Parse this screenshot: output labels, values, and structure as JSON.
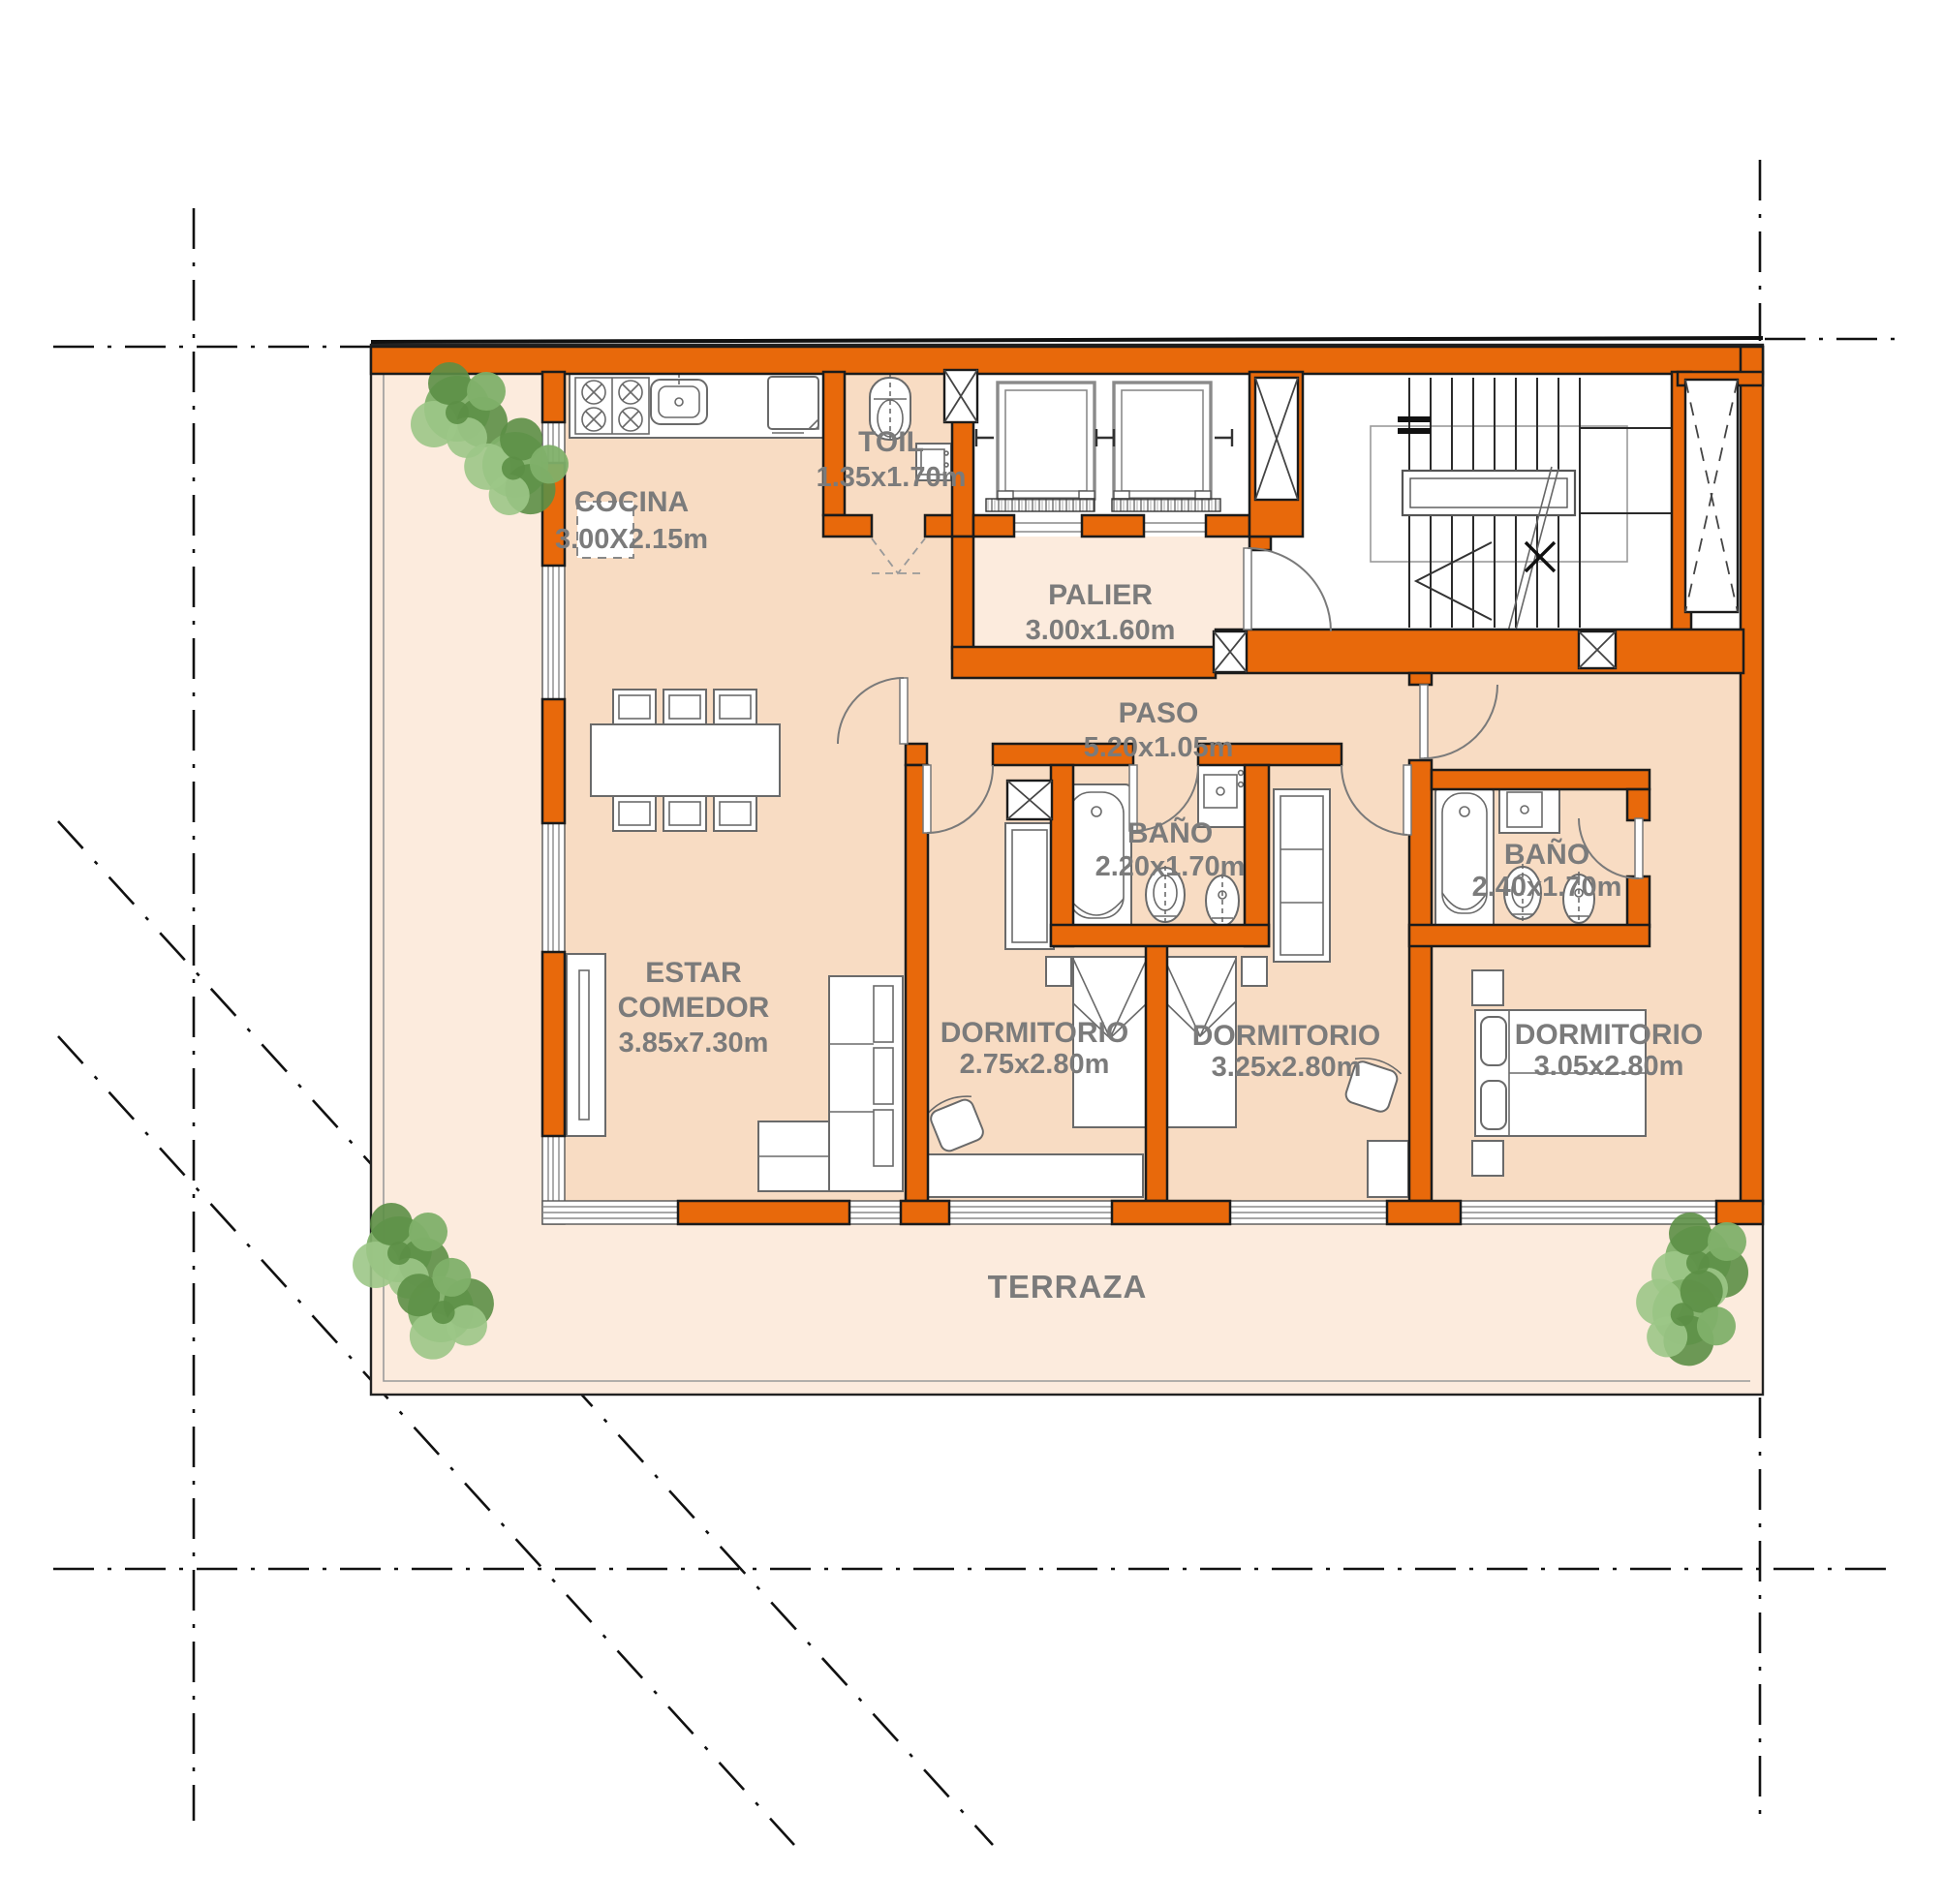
{
  "plan": {
    "type": "apartment-floor-plan",
    "rooms": {
      "cocina": {
        "name": "COCINA",
        "dims": "3.00X2.15m"
      },
      "toil": {
        "name": "TOIL",
        "dims": "1.35x1.70m"
      },
      "palier": {
        "name": "PALIER",
        "dims": "3.00x1.60m"
      },
      "paso": {
        "name": "PASO",
        "dims": "5.20x1.05m"
      },
      "bano1": {
        "name": "BAÑO",
        "dims": "2.20x1.70m"
      },
      "bano2": {
        "name": "BAÑO",
        "dims": "2.40x1.70m"
      },
      "estar": {
        "name1": "ESTAR",
        "name2": "COMEDOR",
        "dims": "3.85x7.30m"
      },
      "dorm1": {
        "name": "DORMITORIO",
        "dims": "2.75x2.80m"
      },
      "dorm2": {
        "name": "DORMITORIO",
        "dims": "3.25x2.80m"
      },
      "dorm3": {
        "name": "DORMITORIO",
        "dims": "3.05x2.80m"
      },
      "terraza": {
        "name": "TERRAZA"
      }
    },
    "colors": {
      "wall": "#E8690B",
      "interior_floor": "#F8DCC3",
      "terrace_floor": "#FCEBDD",
      "label_text": "#7B7B7B",
      "plant_green": "#6FA853",
      "centerline": "#111111"
    }
  }
}
